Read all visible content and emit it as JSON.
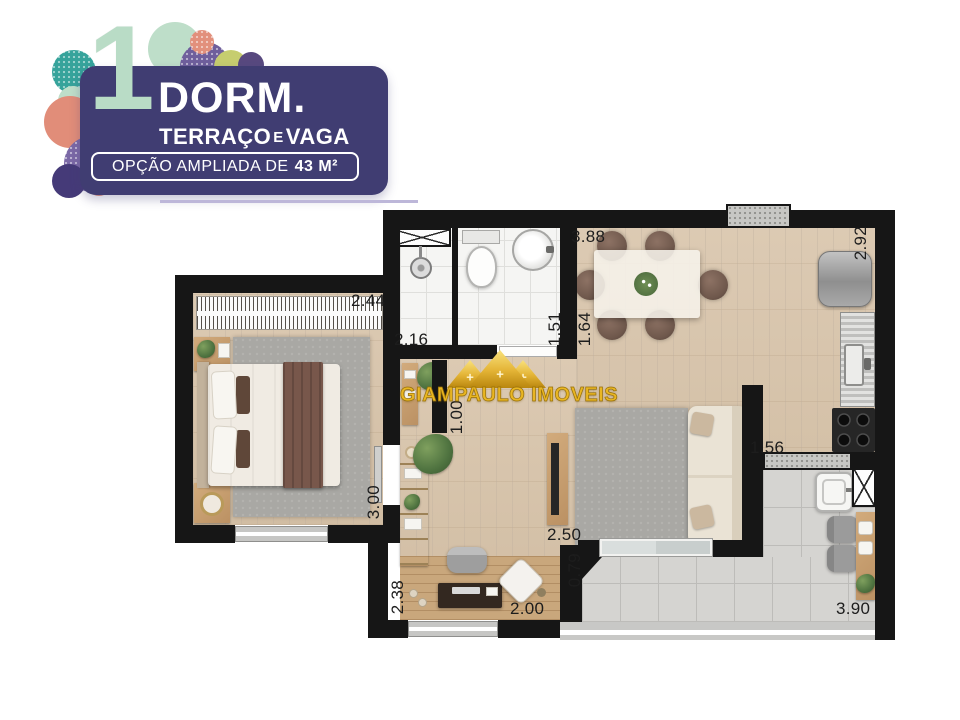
{
  "logo": {
    "number": "1",
    "title": "DORM.",
    "subtitle": {
      "part1": "TERRAÇO",
      "conj": "E",
      "part2": "VAGA"
    },
    "banner": {
      "prefix": "OPÇÃO AMPLIADA DE",
      "area": "43 M²"
    },
    "colors": {
      "box": "#403d72",
      "number": "#b9dcc6",
      "mint": "#bedec9",
      "teal": "#36a39b",
      "coral": "#e18d79",
      "purple": "#7b69a6",
      "lime": "#c6cd6f"
    }
  },
  "watermark": {
    "text": "GIAMPAULO IMOVEIS"
  },
  "plan": {
    "unit": "m",
    "dimensions": [
      {
        "v": "2.44",
        "x": 351,
        "y": 291,
        "vert": false
      },
      {
        "v": "2.16",
        "x": 394,
        "y": 330,
        "vert": false
      },
      {
        "v": "1.51",
        "x": 545,
        "y": 312,
        "vert": true
      },
      {
        "v": "3.88",
        "x": 571,
        "y": 227,
        "vert": false
      },
      {
        "v": "1.64",
        "x": 575,
        "y": 312,
        "vert": true
      },
      {
        "v": "2.92",
        "x": 851,
        "y": 226,
        "vert": true
      },
      {
        "v": "1.00",
        "x": 447,
        "y": 400,
        "vert": true
      },
      {
        "v": "3.00",
        "x": 364,
        "y": 485,
        "vert": true
      },
      {
        "v": "2.50",
        "x": 547,
        "y": 525,
        "vert": false
      },
      {
        "v": "1.56",
        "x": 750,
        "y": 438,
        "vert": false
      },
      {
        "v": "0.79",
        "x": 565,
        "y": 553,
        "vert": true
      },
      {
        "v": "2.38",
        "x": 388,
        "y": 580,
        "vert": true
      },
      {
        "v": "2.00",
        "x": 510,
        "y": 599,
        "vert": false
      },
      {
        "v": "3.90",
        "x": 836,
        "y": 599,
        "vert": false
      }
    ]
  }
}
